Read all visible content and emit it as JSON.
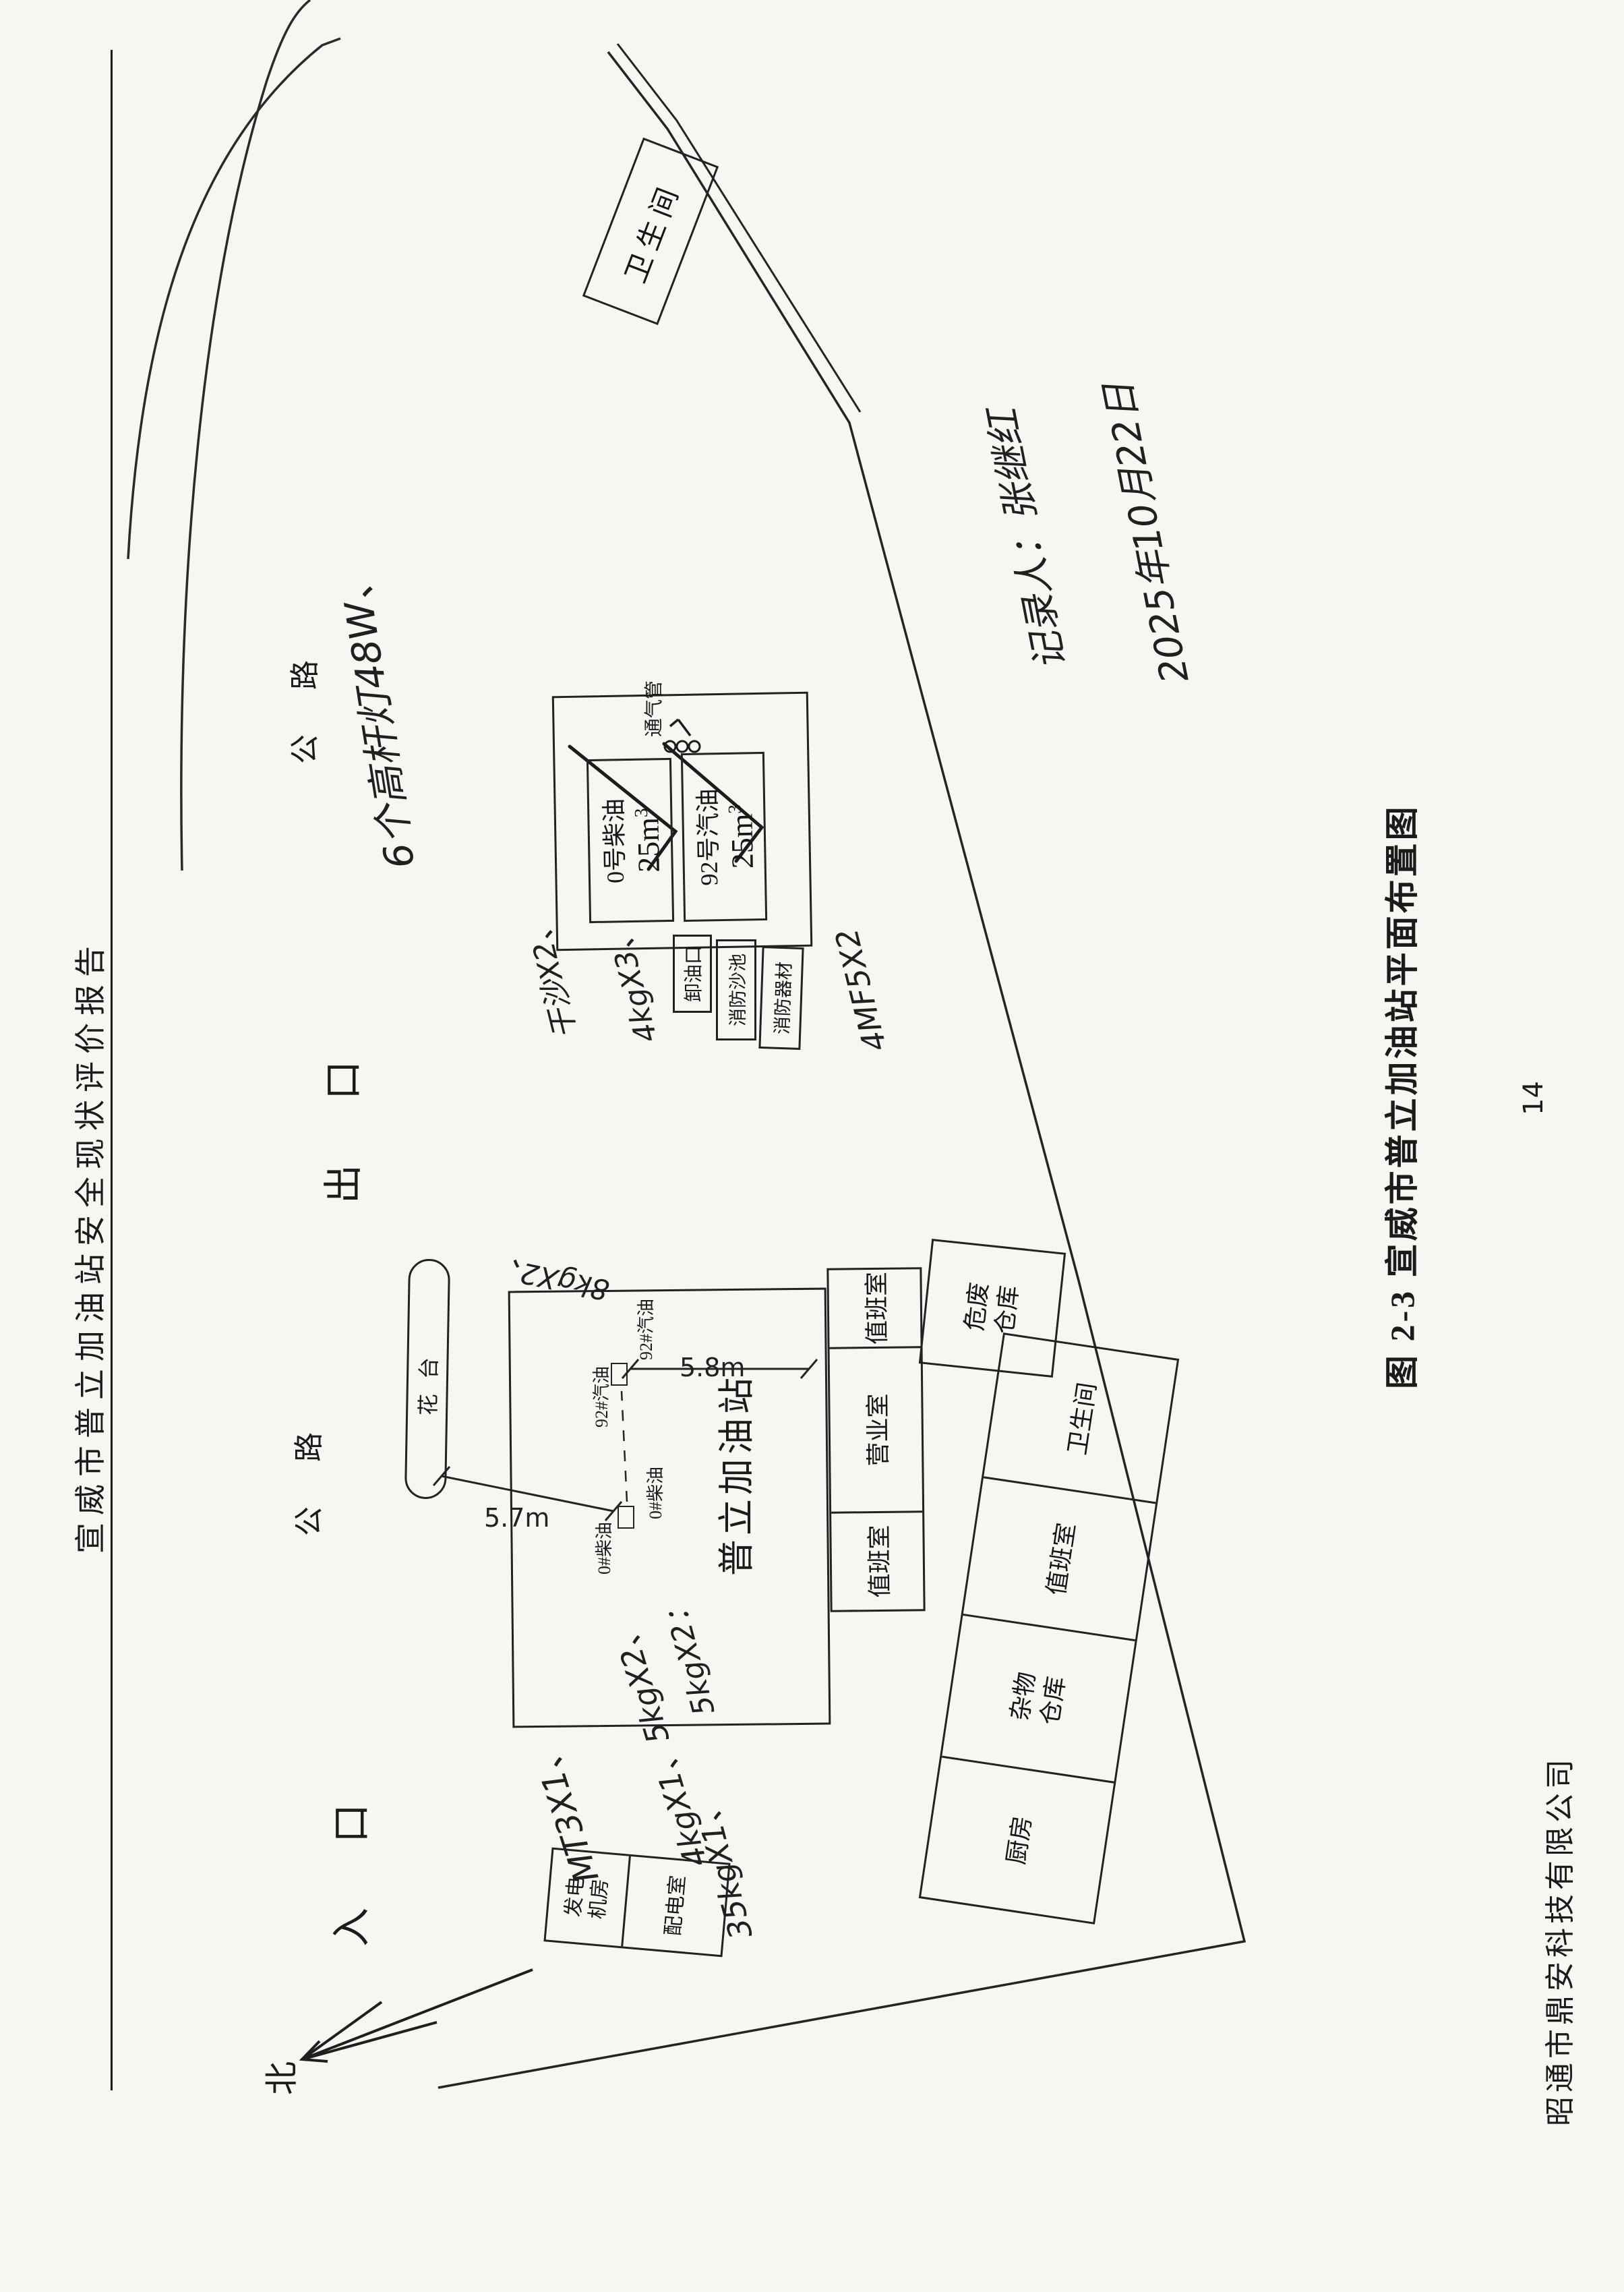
{
  "header": {
    "title": "宣威市普立加油站安全现状评价报告"
  },
  "caption": "图 2-3  宣威市普立加油站平面布置图",
  "footer": {
    "company": "昭通市鼎安科技有限公司",
    "page_number": "14"
  },
  "plan": {
    "north": "北",
    "road_label_1": "公路",
    "road_label_2": "公路",
    "exit_label": "出口",
    "entrance_label": "入口",
    "flower_bed_label": "花台",
    "dim_front": "5.7m",
    "dim_side": "5.8m",
    "canopy_title": "普立加油站",
    "dispenser_92_a": "92#汽油",
    "dispenser_92_b": "92#汽油",
    "dispenser_0_a": "0#柴油",
    "dispenser_0_b": "0#柴油",
    "rooms": {
      "duty_left": "值班室",
      "business": "营业室",
      "duty_right": "值班室",
      "hazard_line1": "危废",
      "hazard_line2": "仓库",
      "kitchen": "厨房",
      "sundry_line1": "杂物",
      "sundry_line2": "仓库",
      "annex_duty": "值班室",
      "annex_toilet": "卫生间",
      "toilet_top": "卫生间",
      "generator_line1": "发电",
      "generator_line2": "机房",
      "power": "配电室"
    },
    "tanks": {
      "t1_name": "0号柴油",
      "t1_vol": "25m",
      "t1_sup": "3",
      "t2_name": "92号汽油",
      "t2_vol": "25m",
      "t2_sup": "3",
      "vent": "通气管",
      "unloading": "卸油口",
      "sand_pool": "消防沙池",
      "fire_equip": "消防器材"
    }
  },
  "handwriting": {
    "lights": "6个高杆灯48W、",
    "recorder": "记录人：张继红",
    "date": "2025年10月22日",
    "note_sand": "干沙X2、",
    "note_4kg3": "4kgX3、",
    "note_mf5": "4MF5X2",
    "note_mt3": "MT3X1、",
    "note_4kg15": "4kgX1、5kgX2、",
    "note_35kg": "35kgX1、",
    "note_5kg2": "5kgX2：",
    "note_8kg2": "8kgX2、"
  }
}
